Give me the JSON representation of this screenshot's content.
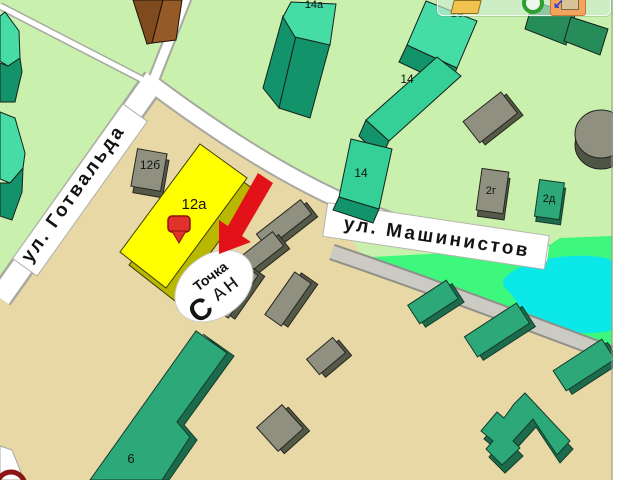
{
  "map": {
    "streets": {
      "gotvalda": "ул. Готвальда",
      "mashinistov": "ул. Машинистов"
    },
    "labels": {
      "b14a": "14а",
      "b16": "16",
      "b14_upper": "14",
      "b14_mid": "14",
      "b12b": "12б",
      "b12a": "12а",
      "b2g": "2г",
      "b2d": "2д",
      "b6": "6"
    },
    "marker": {
      "building": "12а"
    },
    "logo": {
      "text_top": "Точка",
      "text_initial": "С",
      "text_rest": "АН"
    },
    "colors": {
      "park": "#c9f0ad",
      "industrial": "#e8d8a6",
      "field": "#3ef77d",
      "pond": "#0ae8e8",
      "highlight": "#ffff00",
      "highlight_side": "#b8b800",
      "arrow": "#e31219",
      "marker": "#e0312b",
      "logo_red": "#e02020"
    }
  },
  "toolbar": {
    "icons": [
      {
        "name": "folder"
      },
      {
        "name": "rotate"
      },
      {
        "name": "measure"
      }
    ]
  }
}
